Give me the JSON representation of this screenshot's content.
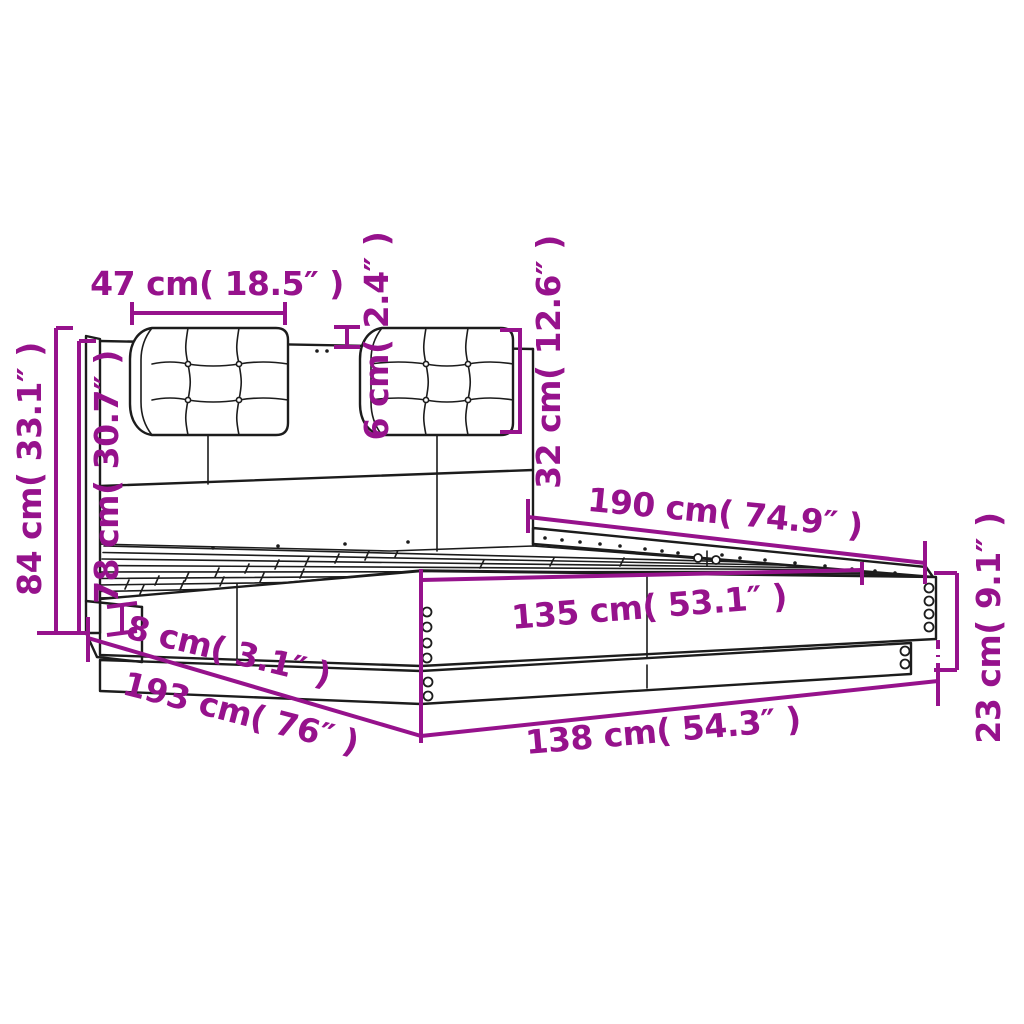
{
  "diagram": {
    "subject": "bed-frame-with-headboard-dimension-diagram",
    "colors": {
      "dimension_accent": "#96128C",
      "outline": "#1c1c1c",
      "background": "#ffffff"
    },
    "dimensions": {
      "cushion_width": {
        "text": "47 cm( 18.5″ )",
        "cm": 47,
        "inches": 18.5
      },
      "cushion_thickness": {
        "text": "6 cm( 2.4″ )",
        "cm": 6,
        "inches": 2.4
      },
      "cushion_height": {
        "text": "32 cm( 12.6″ )",
        "cm": 32,
        "inches": 12.6
      },
      "total_height": {
        "text": "84 cm( 33.1″ )",
        "cm": 84,
        "inches": 33.1
      },
      "headboard_height": {
        "text": "78 cm( 30.7″ )",
        "cm": 78,
        "inches": 30.7
      },
      "inner_length": {
        "text": "190 cm( 74.9″ )",
        "cm": 190,
        "inches": 74.9
      },
      "inner_width": {
        "text": "135 cm( 53.1″ )",
        "cm": 135,
        "inches": 53.1
      },
      "base_height": {
        "text": "8 cm( 3.1″ )",
        "cm": 8,
        "inches": 3.1
      },
      "total_length": {
        "text": "193 cm( 76″ )",
        "cm": 193,
        "inches": 76
      },
      "total_width": {
        "text": "138 cm( 54.3″ )",
        "cm": 138,
        "inches": 54.3
      },
      "frame_height": {
        "text": "23 cm( 9.1″ )",
        "cm": 23,
        "inches": 9.1
      }
    }
  }
}
